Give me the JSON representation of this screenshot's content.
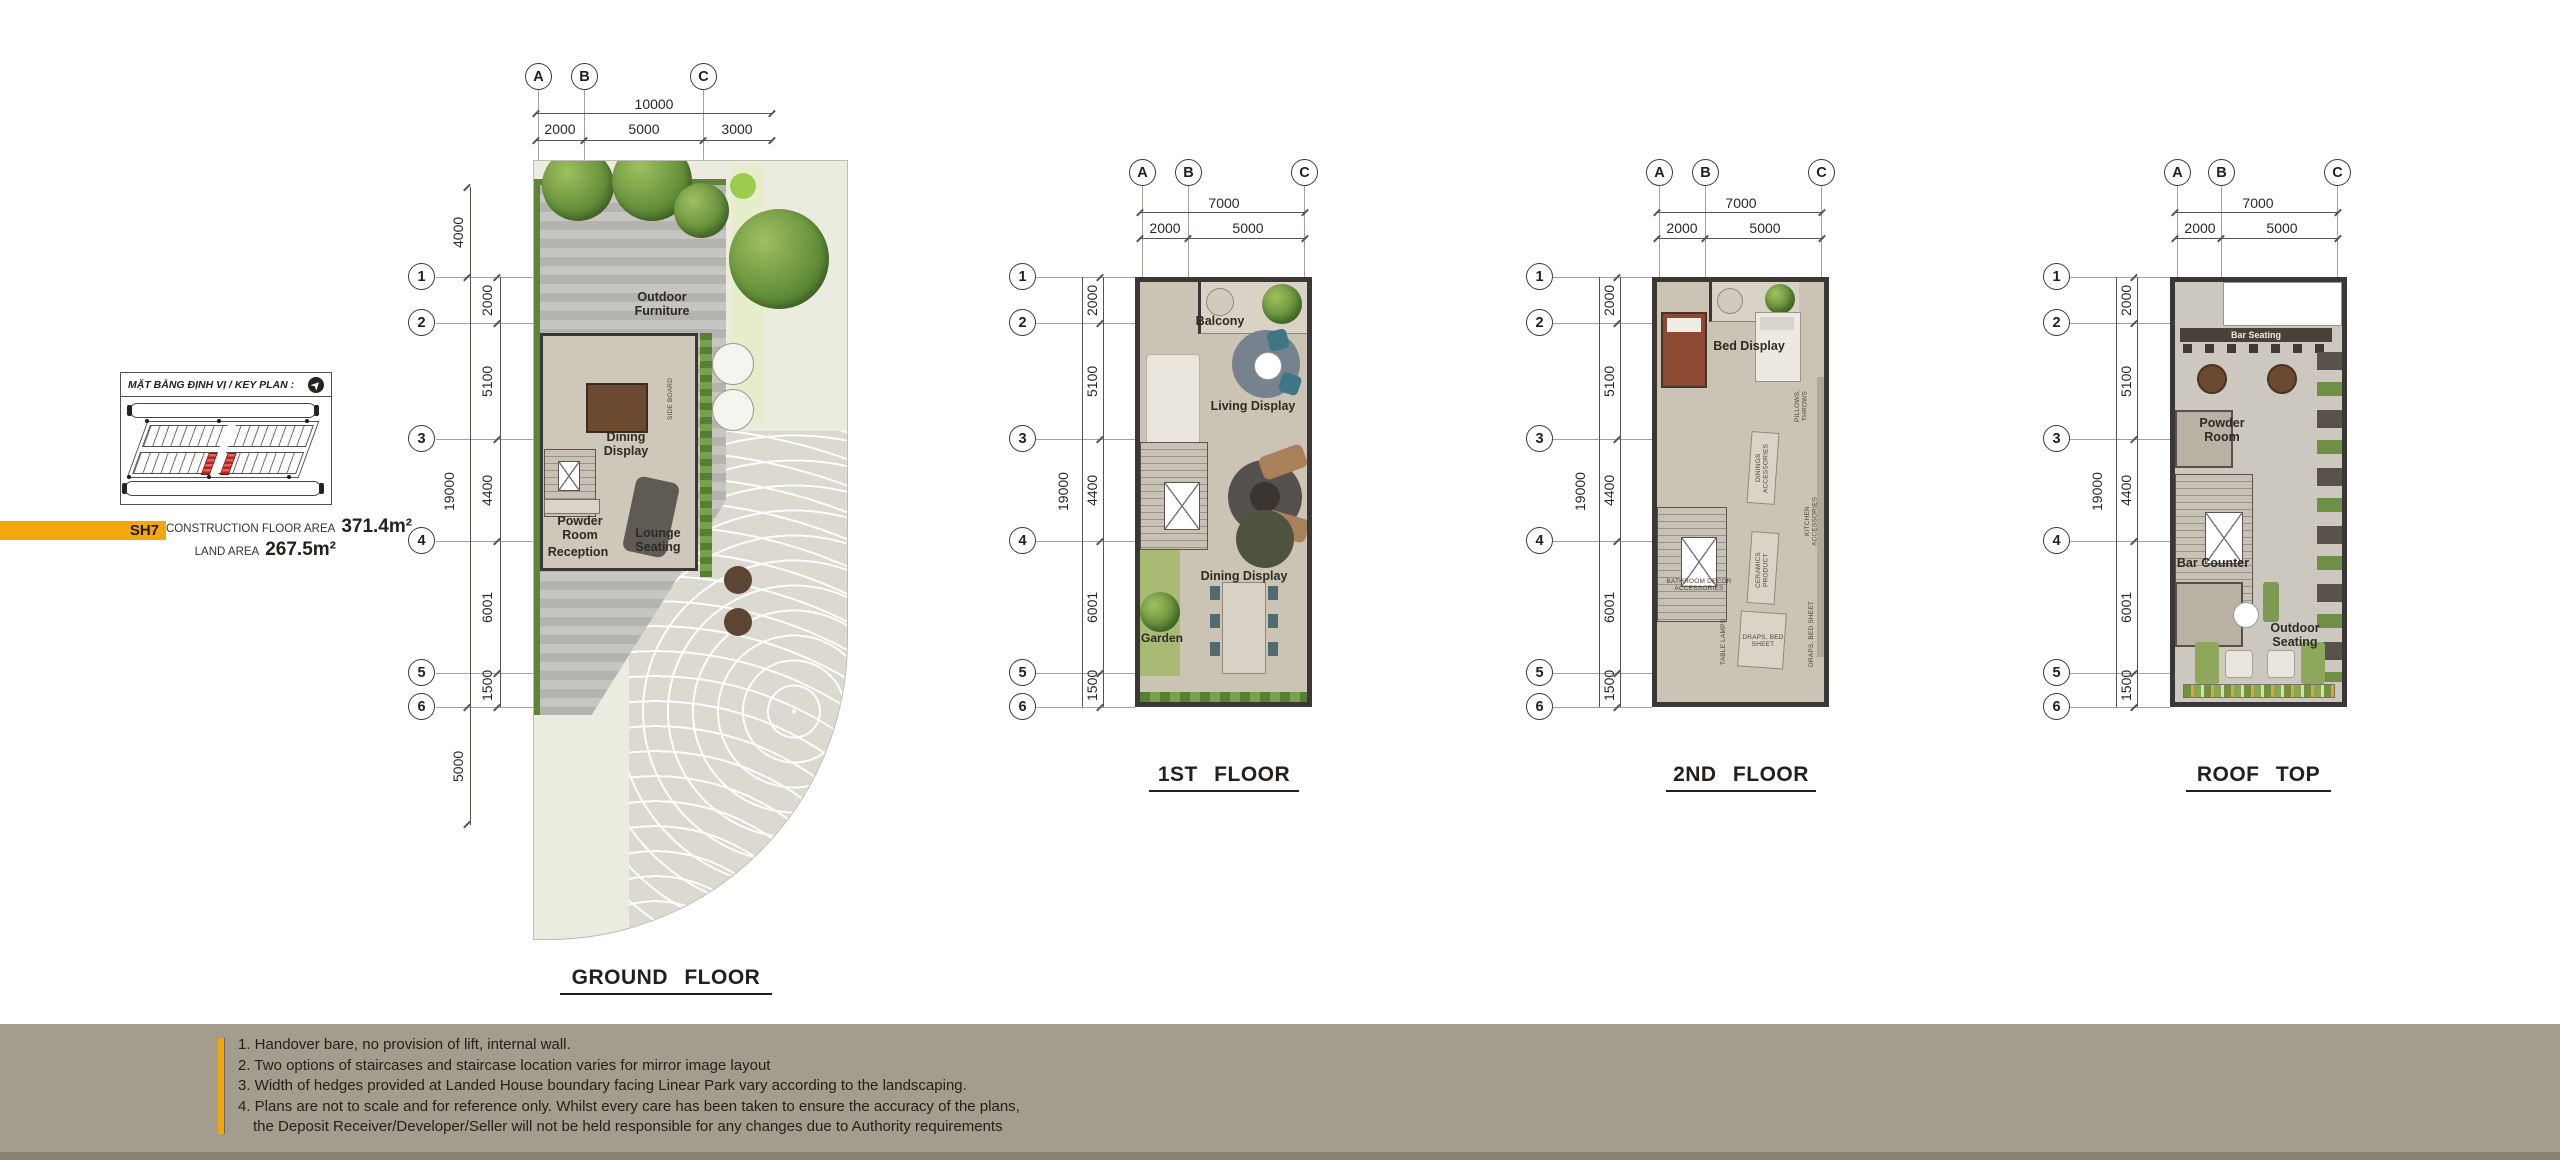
{
  "key_plan": {
    "title": "MẶT BẰNG ĐỊNH VỊ / KEY PLAN :"
  },
  "unit_info": {
    "code": "SH7",
    "construction_label": "CONSTRUCTION FLOOR AREA",
    "construction_value": "371.4m²",
    "land_label": "LAND AREA",
    "land_value": "267.5m²"
  },
  "plans": {
    "ground": {
      "title": "GROUND FLOOR",
      "cols": [
        "A",
        "B",
        "C"
      ],
      "col_total": "10000",
      "col_segs": [
        "2000",
        "5000",
        "3000"
      ],
      "rows": [
        "1",
        "2",
        "3",
        "4",
        "5",
        "6"
      ],
      "row_top": "4000",
      "row_total": "19000",
      "row_segs": [
        "2000",
        "5100",
        "4400",
        "6001",
        "1500"
      ],
      "row_bottom": "5000",
      "labels": {
        "outdoor": "Outdoor Furniture",
        "dining": "Dining Display",
        "powder": "Powder Room",
        "reception": "Reception",
        "lounge": "Lounge Seating",
        "sideboard": "SIDE BOARD"
      }
    },
    "first": {
      "title": "1ST FLOOR",
      "cols": [
        "A",
        "B",
        "C"
      ],
      "col_total": "7000",
      "col_segs": [
        "2000",
        "5000"
      ],
      "rows": [
        "1",
        "2",
        "3",
        "4",
        "5",
        "6"
      ],
      "row_total": "19000",
      "row_segs": [
        "2000",
        "5100",
        "4400",
        "6001",
        "1500"
      ],
      "labels": {
        "balcony": "Balcony",
        "living": "Living Display",
        "dining": "Dining Display",
        "garden": "Garden"
      }
    },
    "second": {
      "title": "2ND FLOOR",
      "cols": [
        "A",
        "B",
        "C"
      ],
      "col_total": "7000",
      "col_segs": [
        "2000",
        "5000"
      ],
      "rows": [
        "1",
        "2",
        "3",
        "4",
        "5",
        "6"
      ],
      "row_total": "19000",
      "row_segs": [
        "2000",
        "5100",
        "4400",
        "6001",
        "1500"
      ],
      "labels": {
        "bed": "Bed Display",
        "pillows": "PILLOWS, THROWS",
        "dinings": "DININGS ACCESSORIES",
        "ceramics": "CERAMICS PRODUCT",
        "kitchen": "KITCHEN ACCESSORIES",
        "bathroom": "BATHROOM DECOR ACCESSORIES",
        "lamps": "TABLE LAMPS",
        "draps": "DRAPS, BED SHEET"
      }
    },
    "roof": {
      "title": "ROOF TOP",
      "cols": [
        "A",
        "B",
        "C"
      ],
      "col_total": "7000",
      "col_segs": [
        "2000",
        "5000"
      ],
      "rows": [
        "1",
        "2",
        "3",
        "4",
        "5",
        "6"
      ],
      "row_total": "19000",
      "row_segs": [
        "2000",
        "5100",
        "4400",
        "6001",
        "1500"
      ],
      "labels": {
        "bar_seating": "Bar Seating",
        "powder": "Powder Room",
        "bar_counter": "Bar Counter",
        "outdoor": "Outdoor Seating"
      }
    }
  },
  "footer": {
    "notes": [
      "1. Handover bare, no provision of lift, internal wall.",
      "2. Two options of staircases and staircase location varies for mirror image layout",
      "3. Width of hedges provided at Landed House boundary facing Linear Park vary according to the landscaping.",
      "4. Plans are not to scale and for reference only. Whilst every care has been taken to ensure the accuracy of the plans,",
      "the Deposit Receiver/Developer/Seller will not be held responsible for any changes due to Authority requirements"
    ]
  }
}
